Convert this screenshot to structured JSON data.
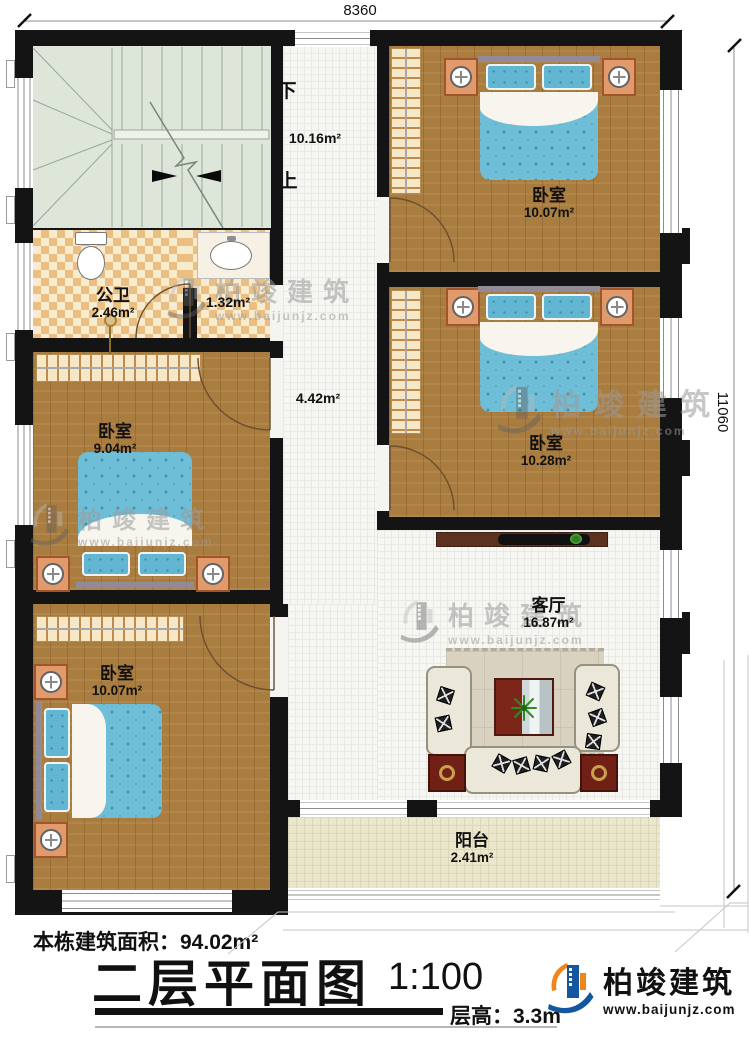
{
  "dimensions": {
    "top": "8360",
    "right": "11060"
  },
  "stairwell": {
    "down": "下",
    "up": "上",
    "area": "10.16m²"
  },
  "rooms": {
    "bedroom_top_right": {
      "name": "卧室",
      "area": "10.07m²"
    },
    "bedroom_mid_right": {
      "name": "卧室",
      "area": "10.28m²"
    },
    "bathroom": {
      "name": "公卫",
      "area": "2.46m²"
    },
    "washroom": {
      "area": "1.32m²"
    },
    "bedroom_mid_left": {
      "name": "卧室",
      "area": "9.04m²"
    },
    "bedroom_bottom_left": {
      "name": "卧室",
      "area": "10.07m²"
    },
    "hallway": {
      "area": "4.42m²"
    },
    "living_room": {
      "name": "客厅",
      "area": "16.87m²"
    },
    "balcony": {
      "name": "阳台",
      "area": "2.41m²"
    }
  },
  "footer": {
    "building_area": "本栋建筑面积：94.02m²",
    "title": "二层平面图",
    "scale": "1:100",
    "floor_height": "层高：3.3m"
  },
  "brand": {
    "name": "柏竣建筑",
    "website": "www.baijunjz.com"
  },
  "watermark": {
    "name": "柏竣建筑",
    "website": "www.baijunjz.com"
  },
  "colors": {
    "wall": "#141414",
    "wood_floor": "#a97c3f",
    "bed_blue": "#6fbed7",
    "checker_tan": "#ecbf81",
    "stairs": "#dee5d9",
    "balcony": "#ebe7cd",
    "brand_blue": "#1456a0",
    "brand_orange": "#f08519"
  }
}
